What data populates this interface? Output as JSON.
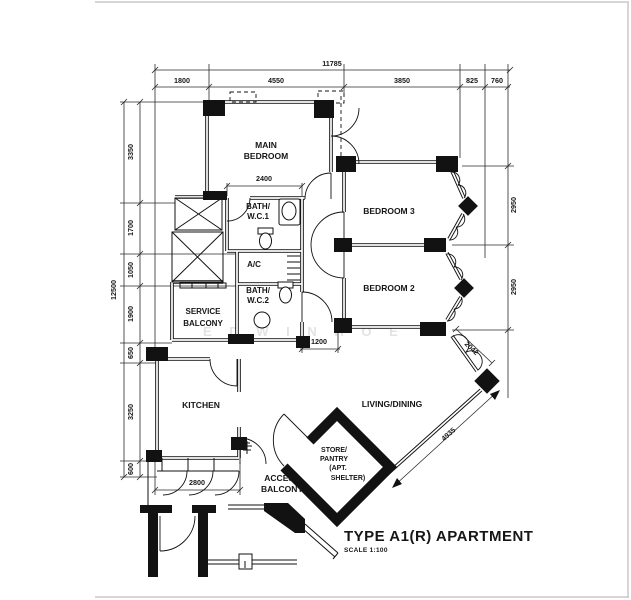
{
  "title": {
    "name": "TYPE A1(R) APARTMENT",
    "scale": "SCALE 1:100"
  },
  "watermark": "E D W I N   H O E",
  "rooms": {
    "main_bedroom": {
      "line1": "MAIN",
      "line2": "BEDROOM"
    },
    "bedroom3": "BEDROOM 3",
    "bedroom2": "BEDROOM 2",
    "bath_wc1": {
      "line1": "BATH/",
      "line2": "W.C.1"
    },
    "bath_wc2": {
      "line1": "BATH/",
      "line2": "W.C.2"
    },
    "ac": "A/C",
    "service_balcony": {
      "line1": "SERVICE",
      "line2": "BALCONY"
    },
    "kitchen": "KITCHEN",
    "living_dining": "LIVING/DINING",
    "store": {
      "line1": "STORE/",
      "line2": "PANTRY",
      "line3": "(APT.",
      "line4": "SHELTER)"
    },
    "access_balcony": {
      "line1": "ACCESS",
      "line2": "BALCONY"
    }
  },
  "dimensions": {
    "top_overall": "11785",
    "top_segments": [
      "1800",
      "4550",
      "3850",
      "825",
      "760"
    ],
    "left_overall": "12500",
    "left_segments": [
      "3350",
      "1700",
      "1050",
      "1900",
      "650",
      "3250",
      "600"
    ],
    "right_segments": [
      "2950",
      "2950"
    ],
    "interior": {
      "bath1_width": "2400",
      "corridor_width": "1200",
      "kitchen_width": "2800",
      "bay_short": "2042",
      "bay_long": "4935"
    }
  }
}
